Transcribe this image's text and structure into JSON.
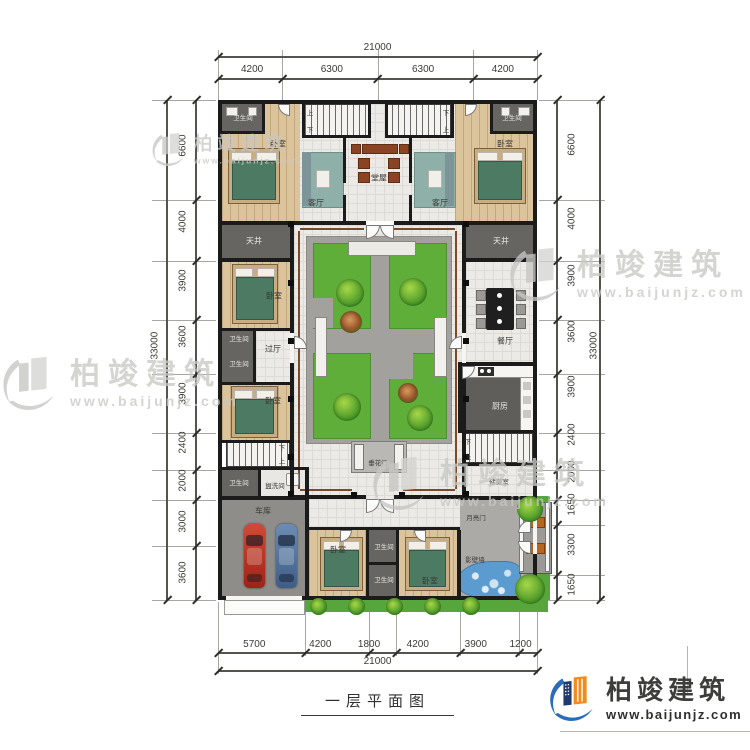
{
  "title": {
    "text": "一层平面图"
  },
  "logo": {
    "brand": "柏竣建筑",
    "url": "www.baijunjz.com"
  },
  "watermark": {
    "brand": "柏竣建筑",
    "url": "www.baijunjz.com"
  },
  "dimensions": {
    "top_total": "21000",
    "top_segments": [
      "4200",
      "6300",
      "6300",
      "4200"
    ],
    "bottom_segments": [
      "5700",
      "4200",
      "1800",
      "4200",
      "3900",
      "1200"
    ],
    "bottom_total": "21000",
    "left_total": "33000",
    "left_segments": [
      "6600",
      "4000",
      "3900",
      "3600",
      "3900",
      "2400",
      "2000",
      "3000",
      "3600"
    ],
    "right_total": "33000",
    "right_segments": [
      "6600",
      "4000",
      "3900",
      "3600",
      "3900",
      "2400",
      "2000",
      "1650",
      "3300",
      "1650"
    ]
  },
  "rooms": {
    "bathroom": "卫生间",
    "bedroom": "卧室",
    "living_room": "客厅",
    "main_hall": "堂屋",
    "dining_room": "餐厅",
    "kitchen": "厨房",
    "skywell": "天井",
    "passage_hall": "过厅",
    "laundry": "盥洗间",
    "garage": "车库",
    "storage": "储藏室",
    "flower_gate": "垂花门",
    "moon_gate": "月亮门",
    "screen_wall": "影壁墙",
    "up": "上",
    "down": "下"
  },
  "colors": {
    "garden_green": "#5fae3a",
    "water_blue": "#5b9bd0",
    "wall": "#1b1b1b",
    "wood_floor": "#dbc39c",
    "logo_orange": "#f08c1e",
    "logo_blue": "#2b6cb8"
  }
}
